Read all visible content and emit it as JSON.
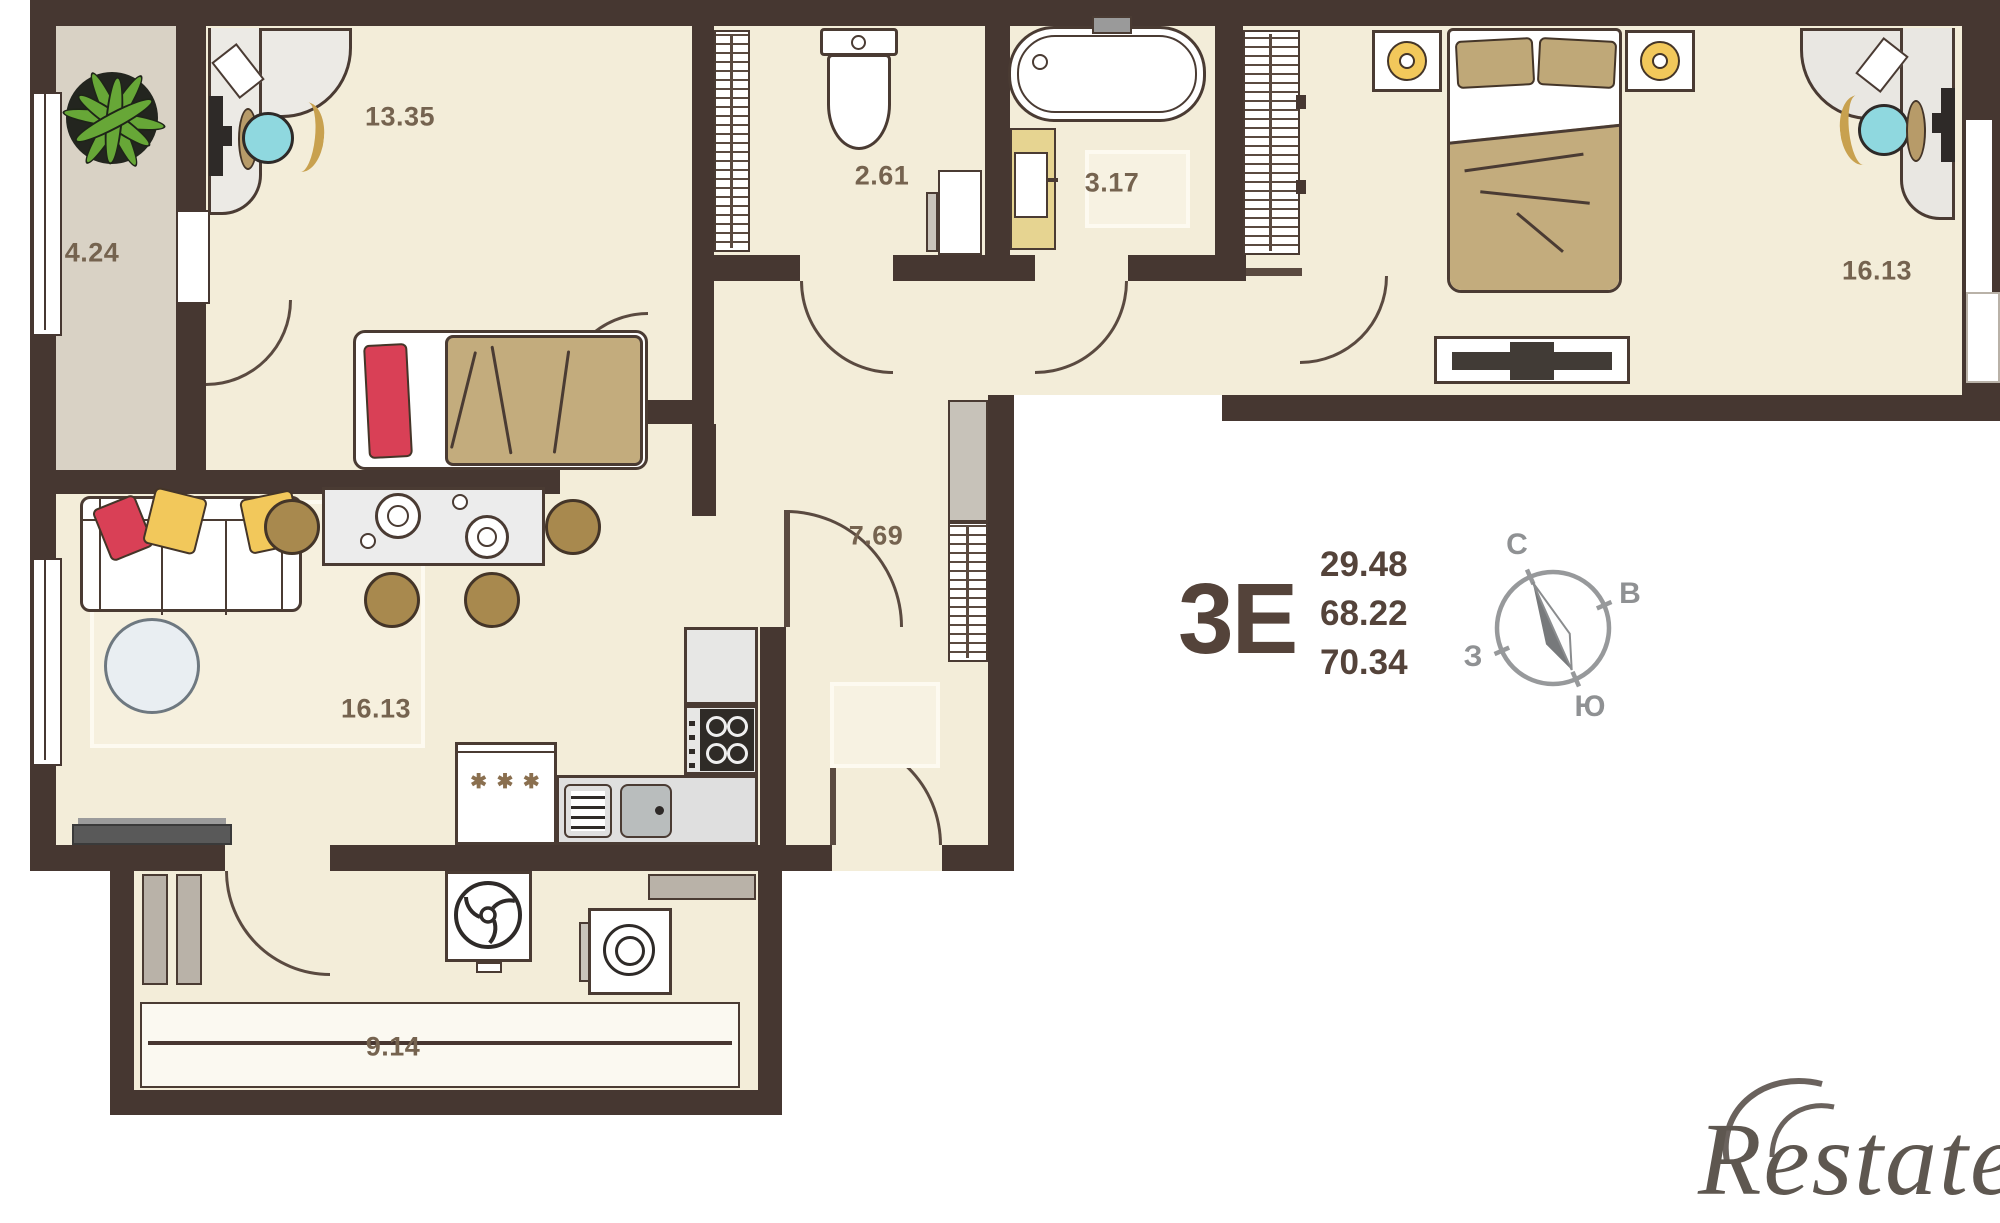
{
  "plan": {
    "unit_label": "3Е",
    "areas": [
      "29.48",
      "68.22",
      "70.34"
    ],
    "rooms": {
      "balcony": {
        "label": "4.24"
      },
      "bedroom1": {
        "label": "13.35"
      },
      "toilet": {
        "label": "2.61"
      },
      "bathroom": {
        "label": "3.17"
      },
      "bedroom2": {
        "label": "16.13"
      },
      "hallway": {
        "label": "7.69"
      },
      "living": {
        "label": "16.13"
      },
      "utility": {
        "label": "9.14"
      }
    },
    "icons": {
      "stove_marks": "✱ ✱ ✱"
    },
    "colors": {
      "wall": "#463731",
      "floor": "#f3edd9",
      "balcony_floor": "#d9d2c5",
      "wood": "#a8894e",
      "blanket": "#c3ac7d",
      "pillow_red": "#d94056",
      "pillow_yellow": "#f2c85b",
      "chair_seat": "#8fd8df",
      "label_text": "#75634f",
      "title_text": "#54433a"
    }
  },
  "compass": {
    "north": "С",
    "east": "В",
    "south": "Ю",
    "west": "З"
  },
  "watermark": {
    "text": "Restate"
  }
}
